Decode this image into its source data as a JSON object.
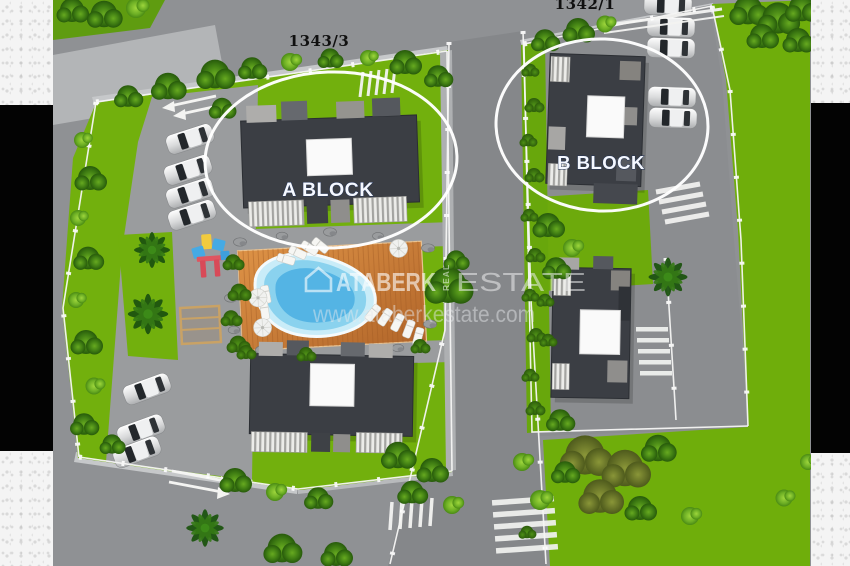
{
  "title": "Residential complex site plan 3D render",
  "labels": {
    "parcel_left": "1343/3",
    "parcel_right": "1342/1",
    "block_a": "A BLOCK",
    "block_b": "B BLOCK"
  },
  "watermark": {
    "logo_icon": "house-icon",
    "brand_word_1": "ATABERK",
    "brand_word_small": "REAL",
    "brand_word_2": "ESTATE",
    "website": "www.ataberkestate.com"
  },
  "colors": {
    "grass": "#72b00d",
    "lawn": "#6fae0b",
    "road": "#8f9194",
    "road_center": "#85878a",
    "pavement": "#9a9c9e",
    "building": "#3b3e44",
    "roof_hatch": "#fafafa",
    "pool_water": "#54b4e4",
    "pool_deck_wood": "#cb7d36",
    "highlight_ellipse": "#ffffff",
    "parcel_label_text": "#101010",
    "block_label_text": "#f5f8ff",
    "frame_bar": "#030303"
  }
}
